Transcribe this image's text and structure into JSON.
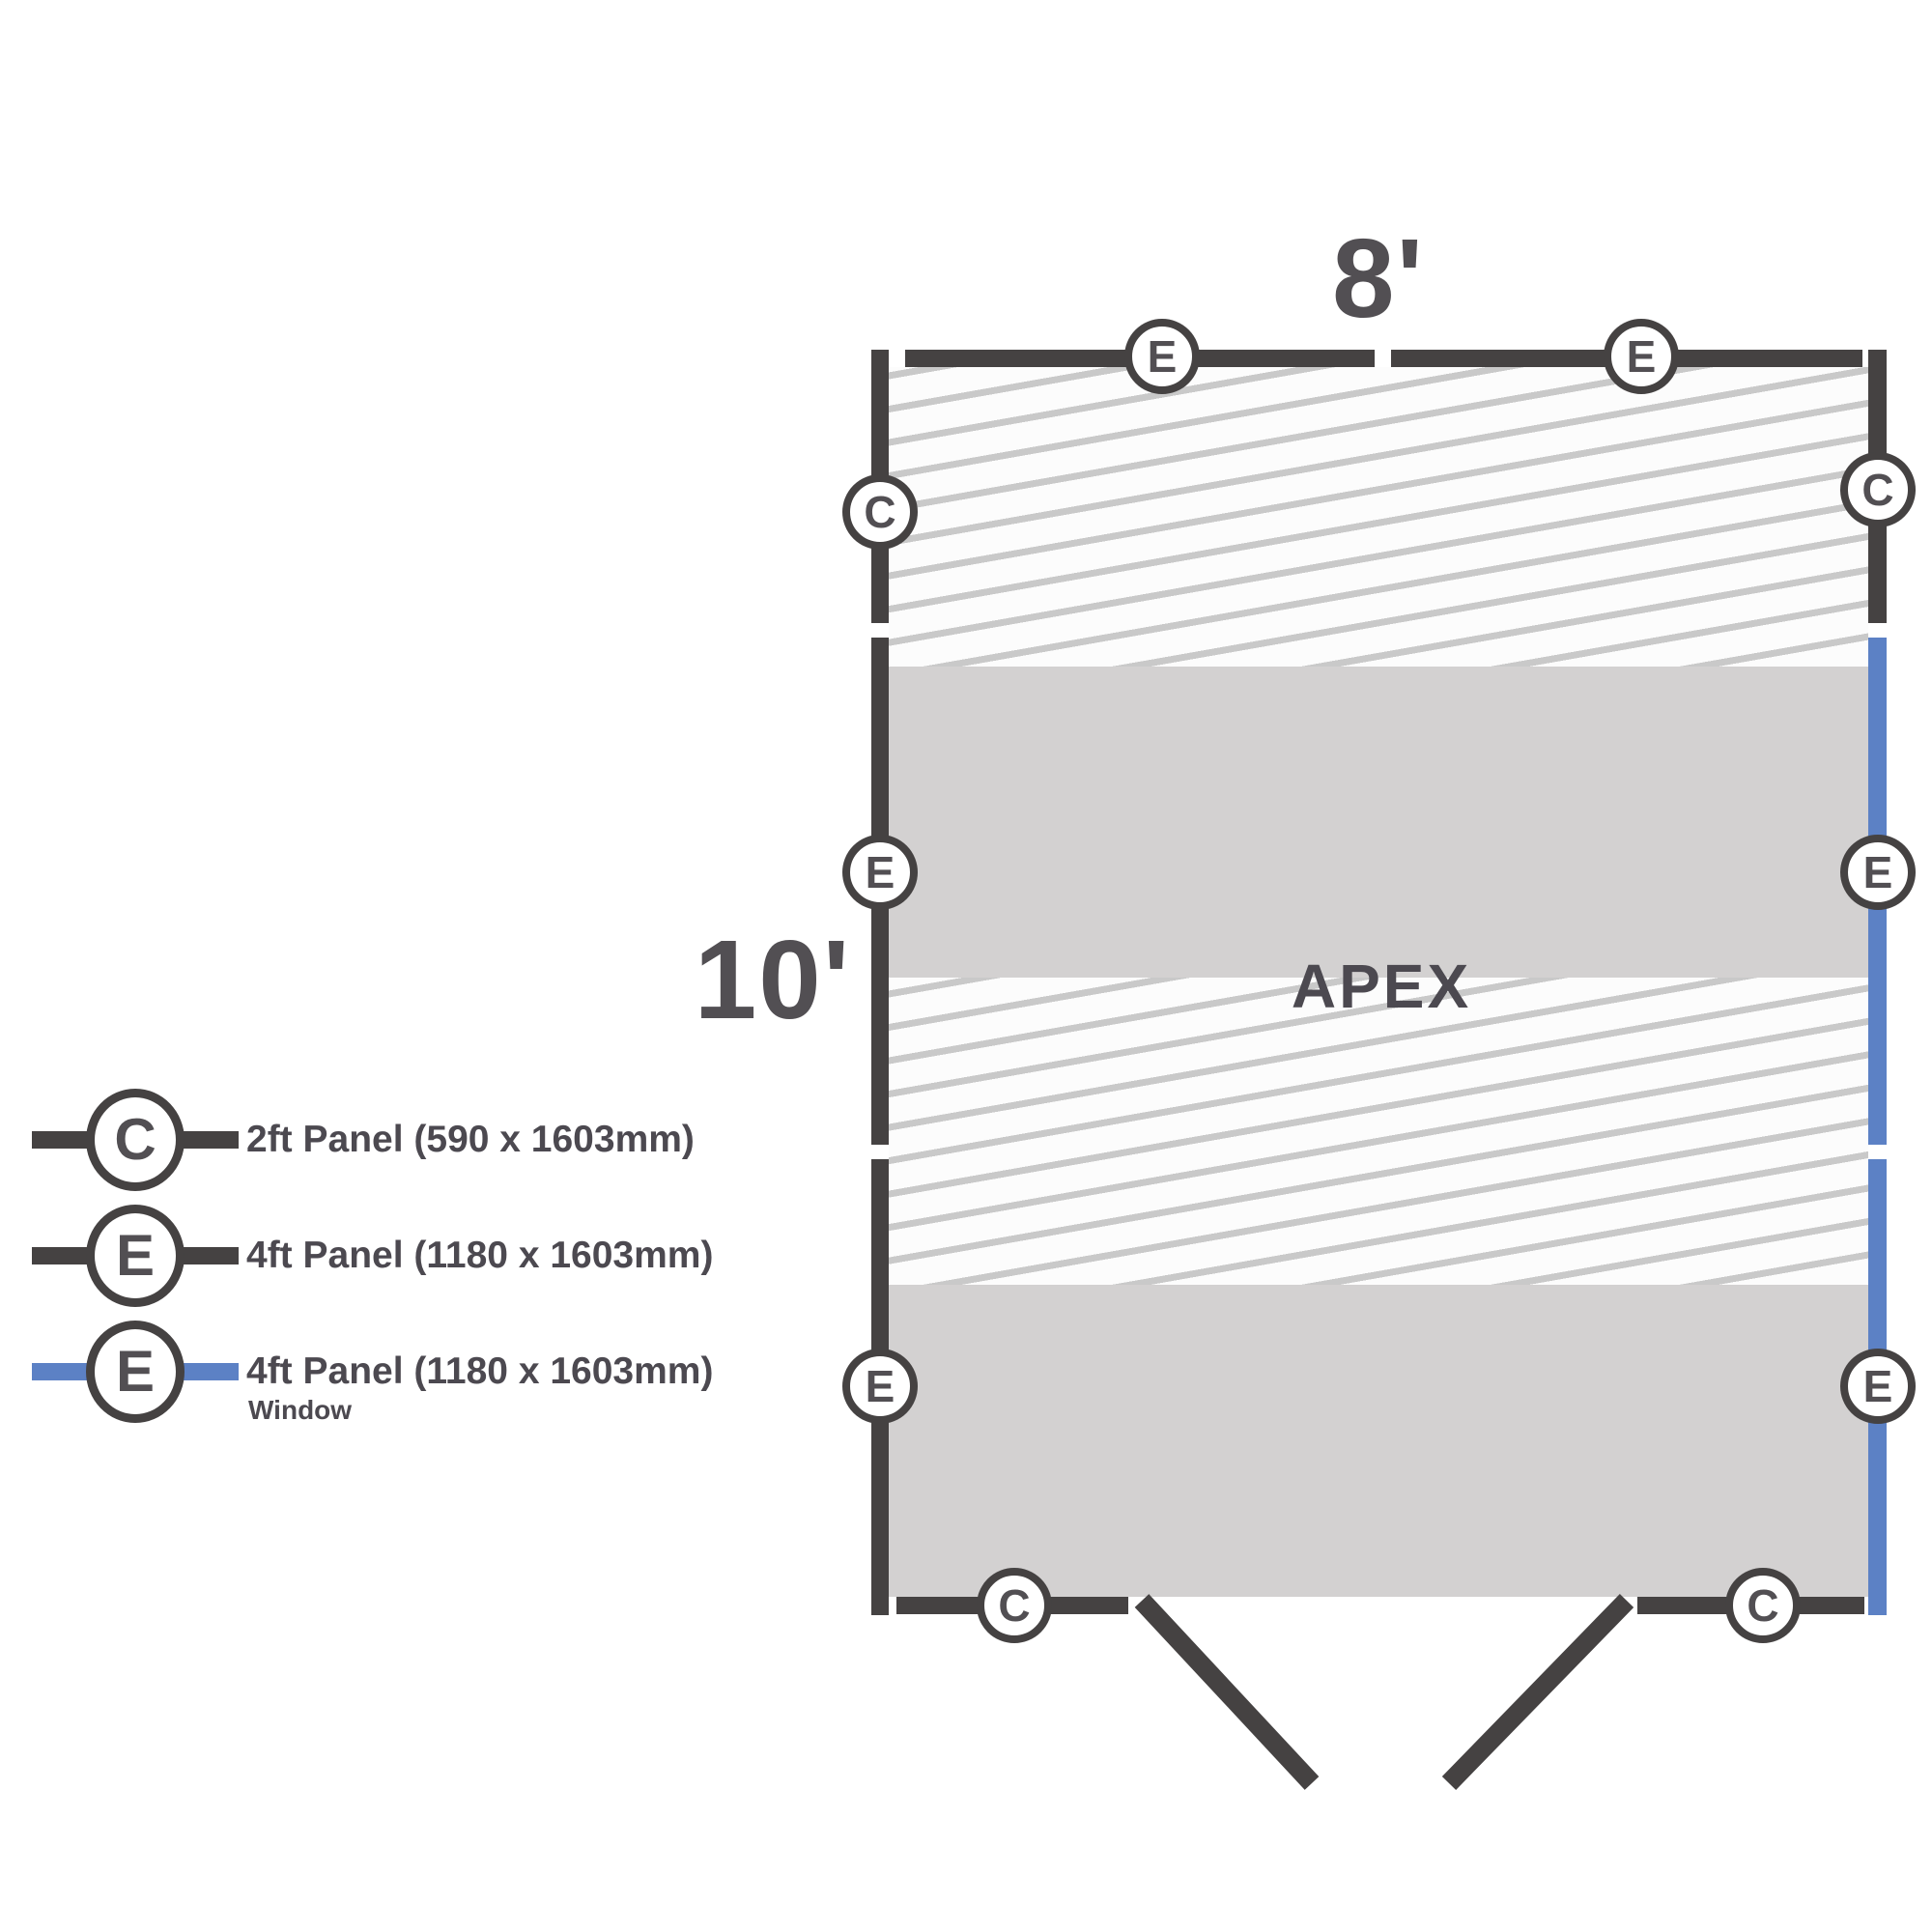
{
  "diagram": {
    "width_label": "8'",
    "depth_label": "10'",
    "roof_style_label": "APEX"
  },
  "markers": {
    "top": [
      "E",
      "E"
    ],
    "left": [
      "C",
      "E",
      "E"
    ],
    "right": [
      "C",
      "E",
      "E"
    ],
    "bottom": [
      "C",
      "C"
    ]
  },
  "legend": {
    "items": [
      {
        "letter": "C",
        "label": "2ft Panel (590 x 1603mm)",
        "sublabel": ""
      },
      {
        "letter": "E",
        "label": "4ft Panel (1180 x 1603mm)",
        "sublabel": ""
      },
      {
        "letter": "E",
        "label": "4ft Panel (1180 x 1603mm)",
        "sublabel": "Window"
      }
    ]
  },
  "colors": {
    "panel_dark": "#454242",
    "panel_window_blue": "#5c81c5",
    "floor_gray": "#d3d1d1",
    "hatch_line": "#c9c9c9",
    "hatch_background": "#fcfcfc",
    "text": "#524f53"
  }
}
